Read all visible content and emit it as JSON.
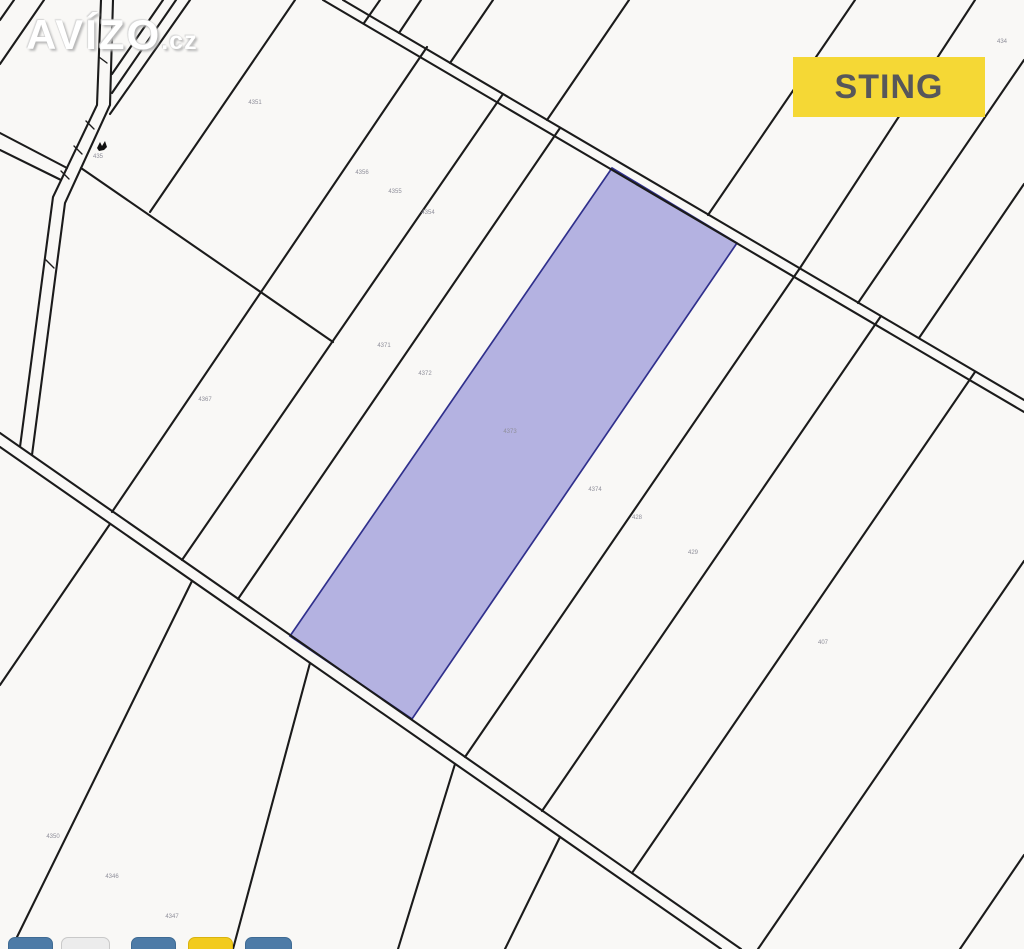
{
  "watermark": {
    "brand": "AVÍZO",
    "suffix": ".cz"
  },
  "agency_badge": {
    "label": "STING",
    "bg": "#f5d835",
    "fg": "#57575a"
  },
  "map": {
    "background": "#f9f8f6",
    "line_color": "#1b1b1b",
    "line_width": 2.1,
    "roads": [
      [
        343,
        0,
        1024,
        400
      ],
      [
        323,
        0,
        1024,
        412
      ],
      [
        0,
        433,
        741,
        949
      ],
      [
        0,
        447,
        721,
        949
      ]
    ],
    "strips": [
      [
        14,
        0,
        0,
        20
      ],
      [
        44,
        0,
        0,
        64
      ],
      [
        163,
        0,
        112,
        74
      ],
      [
        176,
        0,
        112,
        93
      ],
      [
        190,
        0,
        110,
        114
      ],
      [
        295,
        0,
        150,
        212
      ],
      [
        81,
        168,
        333,
        342
      ],
      [
        0,
        133,
        67,
        168
      ],
      [
        0,
        150,
        61,
        180
      ],
      [
        380,
        0,
        364,
        23
      ],
      [
        421,
        0,
        399,
        33
      ],
      [
        493,
        0,
        450,
        63
      ],
      [
        629,
        0,
        547,
        120
      ],
      [
        855,
        0,
        708,
        215
      ],
      [
        975,
        0,
        800,
        268
      ],
      [
        1024,
        60,
        858,
        303
      ],
      [
        1024,
        184,
        919,
        338
      ],
      [
        427,
        47,
        112,
        512
      ],
      [
        503,
        94,
        182,
        560
      ],
      [
        560,
        128,
        238,
        599
      ],
      [
        800,
        268,
        465,
        757
      ],
      [
        881,
        316,
        542,
        811
      ],
      [
        975,
        372,
        632,
        873
      ],
      [
        110,
        524,
        0,
        685
      ],
      [
        192,
        581,
        17,
        937
      ],
      [
        310,
        663,
        233,
        949
      ],
      [
        455,
        764,
        398,
        949
      ],
      [
        560,
        837,
        505,
        949
      ],
      [
        1024,
        561,
        758,
        949
      ],
      [
        1024,
        855,
        960,
        949
      ]
    ],
    "paths": [
      "101,0 97,105 53,197 20,447",
      "113,0 110,105 65,203 32,455"
    ],
    "ticks": [
      [
        99,
        57,
        107,
        63
      ],
      [
        86,
        121,
        94,
        129
      ],
      [
        74,
        146,
        82,
        154
      ],
      [
        61,
        171,
        69,
        179
      ],
      [
        46,
        260,
        54,
        268
      ]
    ],
    "highlight_parcel": {
      "points": "612,168 737,243 412,719 290,636",
      "fill": "#b4b2e1",
      "stroke": "#30308c"
    },
    "symbol": {
      "x": 97,
      "y": 141,
      "color": "#111111"
    },
    "number_color": "#8f8f9a",
    "parcel_numbers": [
      {
        "x": 98,
        "y": 157,
        "label": "435"
      },
      {
        "x": 255,
        "y": 103,
        "label": "4351"
      },
      {
        "x": 1002,
        "y": 42,
        "label": "434"
      },
      {
        "x": 362,
        "y": 173,
        "label": "4356"
      },
      {
        "x": 395,
        "y": 192,
        "label": "4355"
      },
      {
        "x": 428,
        "y": 213,
        "label": "4354"
      },
      {
        "x": 205,
        "y": 400,
        "label": "4367"
      },
      {
        "x": 384,
        "y": 346,
        "label": "4371"
      },
      {
        "x": 425,
        "y": 374,
        "label": "4372"
      },
      {
        "x": 510,
        "y": 432,
        "label": "4373"
      },
      {
        "x": 595,
        "y": 490,
        "label": "4374"
      },
      {
        "x": 637,
        "y": 518,
        "label": "428"
      },
      {
        "x": 693,
        "y": 553,
        "label": "429"
      },
      {
        "x": 823,
        "y": 643,
        "label": "407"
      },
      {
        "x": 53,
        "y": 837,
        "label": "4350"
      },
      {
        "x": 112,
        "y": 877,
        "label": "4346"
      },
      {
        "x": 172,
        "y": 917,
        "label": "4347"
      }
    ]
  },
  "share_buttons": [
    {
      "left": 8,
      "width": 45,
      "color": "#4d7ba7",
      "border": "#3f6b94"
    },
    {
      "left": 61,
      "width": 49,
      "color": "#ececec",
      "border": "#c9c9c9"
    },
    {
      "left": 131,
      "width": 45,
      "color": "#4d7ba7",
      "border": "#3f6b94"
    },
    {
      "left": 188,
      "width": 45,
      "color": "#f2cb1d",
      "border": "#d9b30e"
    },
    {
      "left": 245,
      "width": 47,
      "color": "#4d7ba7",
      "border": "#3f6b94"
    }
  ]
}
